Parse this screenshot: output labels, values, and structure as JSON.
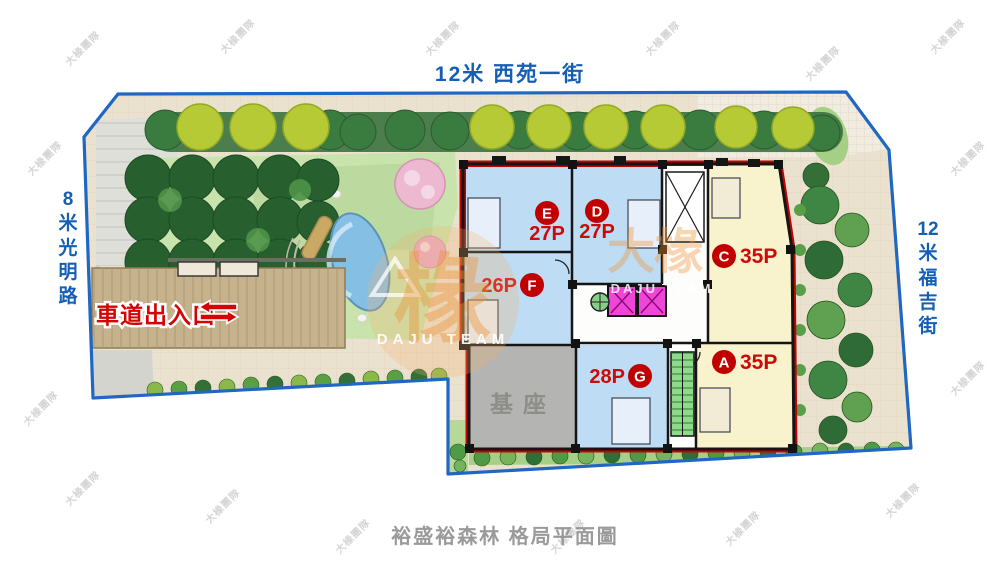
{
  "page": {
    "caption": "裕盛裕森林 格局平面圖"
  },
  "streets": {
    "top": "12米 西苑一街",
    "left": "8米 光明路",
    "right": "12米 福吉街"
  },
  "site": {
    "driveway_label": "車道出入口",
    "base_label": "基座"
  },
  "units": [
    {
      "id": "E",
      "capacity": "27P",
      "color": "#bedcf4"
    },
    {
      "id": "D",
      "capacity": "27P",
      "color": "#bedcf4"
    },
    {
      "id": "C",
      "capacity": "35P",
      "color": "#f8f3cc"
    },
    {
      "id": "F",
      "capacity": "26P",
      "color": "#bedcf4"
    },
    {
      "id": "G",
      "capacity": "28P",
      "color": "#bedcf4"
    },
    {
      "id": "A",
      "capacity": "35P",
      "color": "#f8f3cc"
    }
  ],
  "watermark": {
    "logo_char": "椽",
    "brand_cn": "大椽",
    "team_cn": "大椽團隊",
    "team_en": "DAJU TEAM"
  },
  "colors": {
    "street_text": "#145fb4",
    "boundary_blue": "#1f67c2",
    "building_outline": "#c00404",
    "unit_blue": "#bedcf4",
    "unit_yellow": "#f8f3cc",
    "badge_red": "#c00000",
    "driveway_red": "#d40404"
  }
}
